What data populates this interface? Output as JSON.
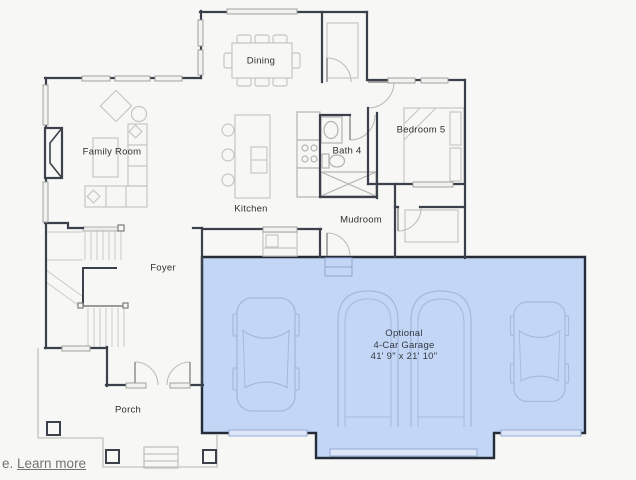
{
  "plan": {
    "rooms": [
      {
        "name": "Dining"
      },
      {
        "name": "Family Room"
      },
      {
        "name": "Bedroom 5"
      },
      {
        "name": "Bath 4"
      },
      {
        "name": "Kitchen"
      },
      {
        "name": "Mudroom"
      },
      {
        "name": "Foyer"
      },
      {
        "name": "Porch"
      }
    ],
    "garage": {
      "line1": "Optional",
      "line2": "4-Car Garage",
      "line3": "41' 9\" x 21' 10\""
    }
  },
  "footer": {
    "prefix_text": "e.",
    "link_label": "Learn more"
  },
  "colors": {
    "background": "#f7f7f5",
    "garage_fill": "#c3d6f5",
    "garage_outline": "#252c38",
    "garage_door_bar": "#dce6f8",
    "wall": "#3a414b",
    "furniture_line": "#c6c6c3",
    "car_line": "#a3b9de",
    "label_text": "#2f2f2d",
    "link_text": "#73736e"
  }
}
